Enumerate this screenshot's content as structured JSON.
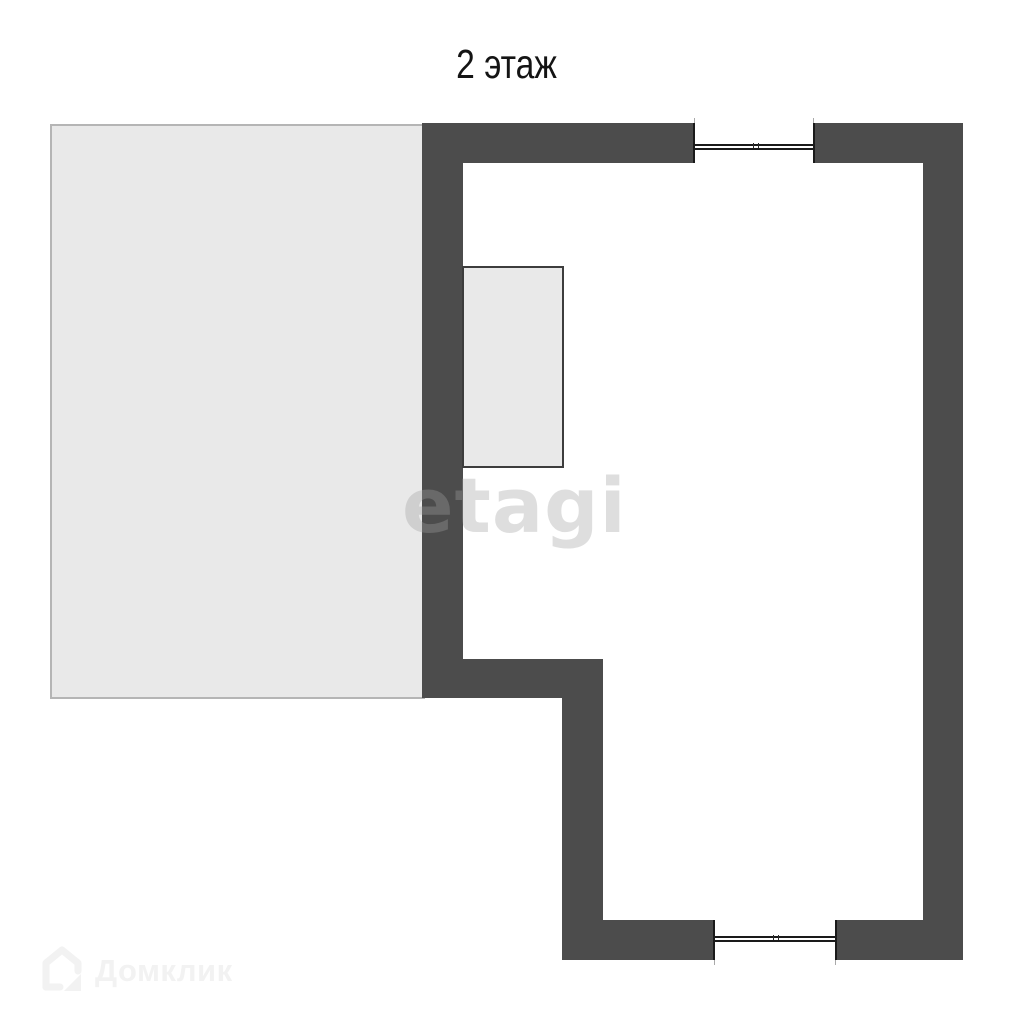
{
  "page": {
    "title": "2 этаж"
  },
  "watermark": {
    "label": "etagi"
  },
  "footer_logo": {
    "label": "Домклик",
    "icon": "house-icon"
  },
  "floorplan": {
    "kind": "floor-plan",
    "floor": "2",
    "features": {
      "left_area": "unlabeled attic/roof area",
      "main_room": "L-shaped room",
      "closet": "built-in block on left wall",
      "windows": [
        "top wall window",
        "bottom wall window"
      ]
    }
  },
  "colors": {
    "background": "#ffffff",
    "wall": "#4c4c4c",
    "room_fill": "#ffffff",
    "area_fill": "#e9e9e9",
    "area_border": "#b5b5b5",
    "closet_border": "#3d3d3d",
    "window_line": "#1a1a1a",
    "title_text": "#141414",
    "watermark_text": "rgba(160,160,160,0.35)",
    "footer_logo_text": "#f2f2f2"
  }
}
